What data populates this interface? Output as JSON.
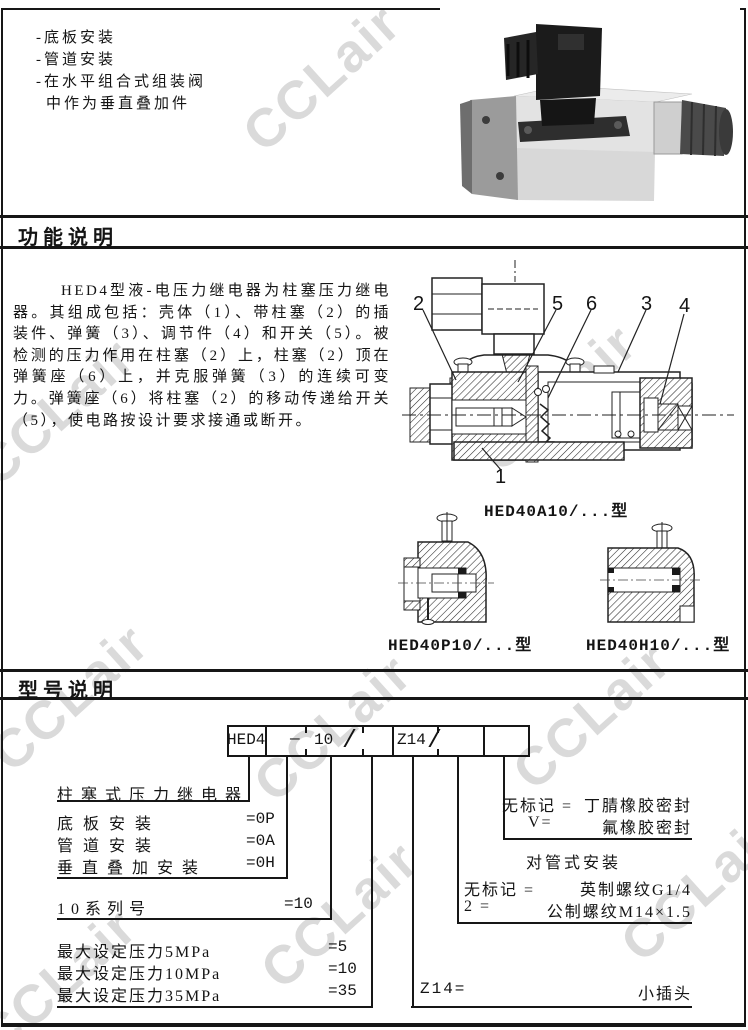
{
  "watermark": {
    "text": "CCLair"
  },
  "intro": {
    "lines": [
      "-底板安装",
      "-管道安装",
      "-在水平组合式组装阀",
      "中作为垂直叠加件"
    ]
  },
  "headers": {
    "function": "功能说明",
    "model": "型号说明"
  },
  "function_section": {
    "paragraph": "HED4型液-电压力继电器为柱塞压力继电器。其组成包括：壳体（1）、带柱塞（2）的插装件、弹簧（3）、调节件（4）和开关（5）。被检测的压力作用在柱塞（2）上，柱塞（2）顶在弹簧座（6）上，并克服弹簧（3）的连续可变力。弹簧座（6）将柱塞（2）的移动传递给开关（5），使电路按设计要求接通或断开。",
    "callouts": [
      "2",
      "5",
      "6",
      "3",
      "4",
      "1"
    ],
    "captions": {
      "main": "HED40A10/...型",
      "plate": "HED40P10/...型",
      "stack": "HED40H10/...型"
    }
  },
  "model_section": {
    "box": {
      "prefix": "HED4",
      "dash": "—",
      "series": "10",
      "slash1": "/",
      "plug": "Z14",
      "slash2": "/"
    },
    "left_labels": [
      {
        "label": "柱塞式压力继电器",
        "value": ""
      },
      {
        "label": "底板安装",
        "value": "=0P"
      },
      {
        "label": "管道安装",
        "value": "=0A"
      },
      {
        "label": "垂直叠加安装",
        "value": "=0H"
      },
      {
        "label": "10系列号",
        "value": "=10"
      },
      {
        "label": "最大设定压力5MPa",
        "value": "=5"
      },
      {
        "label": "最大设定压力10MPa",
        "value": "=10"
      },
      {
        "label": "最大设定压力35MPa",
        "value": "=35"
      }
    ],
    "seal": {
      "row1_key": "无标记 =",
      "row1_val": "丁腈橡胶密封",
      "row2_key": "V=",
      "row2_val": "氟橡胶密封"
    },
    "pipe": {
      "title": "对管式安装",
      "row1_key": "无标记 =",
      "row1_val": "英制螺纹G1/4",
      "row2_key": "2 =",
      "row2_val": "公制螺纹M14×1.5"
    },
    "plug": {
      "key": "Z14=",
      "val": "小插头"
    }
  }
}
